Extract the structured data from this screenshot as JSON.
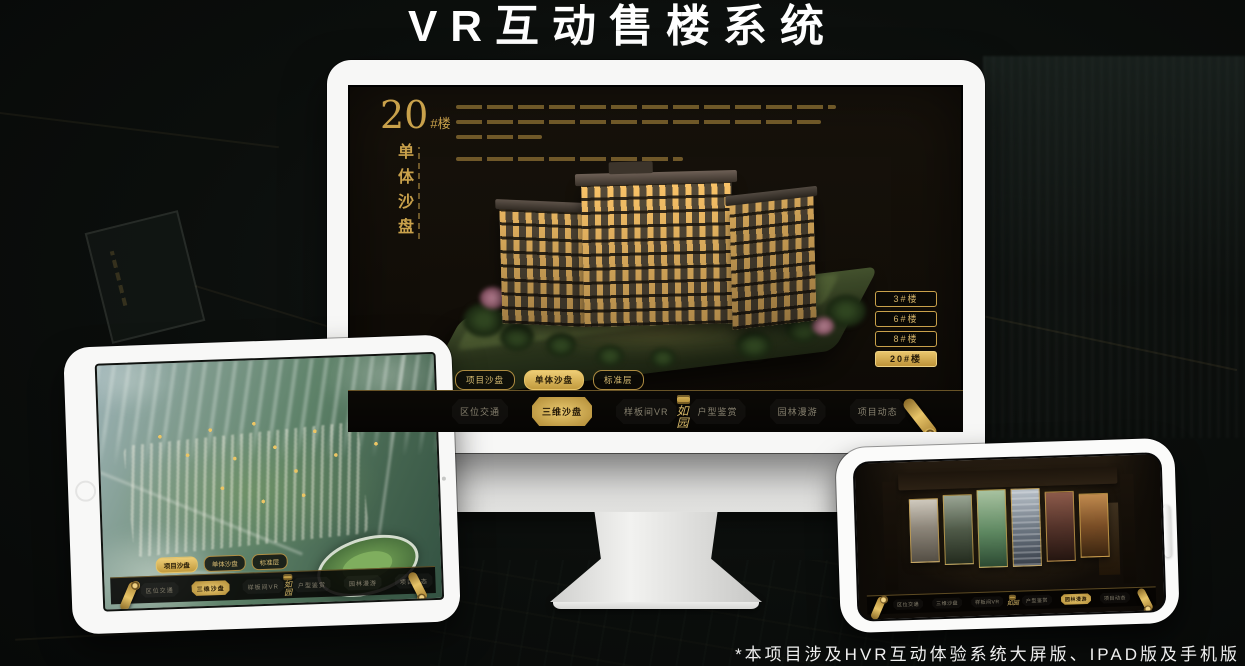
{
  "page": {
    "title": "VR互动售楼系统",
    "footnote": "*本项目涉及HVR互动体验系统大屏版、IPAD版及手机版"
  },
  "colors": {
    "gold": "#c9a14b",
    "gold_bright": "#e7c468",
    "screen_bg": "#14100a",
    "nav_bg": "#0a0805"
  },
  "monitor_app": {
    "headline": {
      "number": "20",
      "suffix": "#楼",
      "subtitle_vertical": "单体沙盘"
    },
    "floor_buttons": [
      {
        "label": "3#楼",
        "active": false
      },
      {
        "label": "6#楼",
        "active": false
      },
      {
        "label": "8#楼",
        "active": false
      },
      {
        "label": "20#楼",
        "active": true
      }
    ],
    "view_tabs": [
      {
        "label": "项目沙盘",
        "active": false
      },
      {
        "label": "单体沙盘",
        "active": true
      },
      {
        "label": "标准层",
        "active": false
      }
    ],
    "nav_left": [
      {
        "label": "区位交通",
        "active": false
      },
      {
        "label": "三维沙盘",
        "active": true
      },
      {
        "label": "样板间VR",
        "active": false
      }
    ],
    "nav_right": [
      {
        "label": "户型鉴赏",
        "active": false
      },
      {
        "label": "园林漫游",
        "active": false
      },
      {
        "label": "项目动态",
        "active": false
      }
    ],
    "logo_text": "如园"
  },
  "tablet_app": {
    "view_tabs": [
      {
        "label": "项目沙盘",
        "active": true
      },
      {
        "label": "单体沙盘",
        "active": false
      },
      {
        "label": "标准层",
        "active": false
      }
    ],
    "nav_left": [
      {
        "label": "区位交通",
        "active": false
      },
      {
        "label": "三维沙盘",
        "active": true
      },
      {
        "label": "样板间VR",
        "active": false
      }
    ],
    "nav_right": [
      {
        "label": "户型鉴赏",
        "active": false
      },
      {
        "label": "园林漫游",
        "active": false
      },
      {
        "label": "项目动态",
        "active": false
      }
    ],
    "logo_text": "如园"
  },
  "phone_app": {
    "nav_left": [
      {
        "label": "区位交通",
        "active": false
      },
      {
        "label": "三维沙盘",
        "active": false
      },
      {
        "label": "样板间VR",
        "active": false
      }
    ],
    "nav_right": [
      {
        "label": "户型鉴赏",
        "active": false
      },
      {
        "label": "园林漫游",
        "active": true
      },
      {
        "label": "项目动态",
        "active": false
      }
    ],
    "logo_text": "如园"
  }
}
